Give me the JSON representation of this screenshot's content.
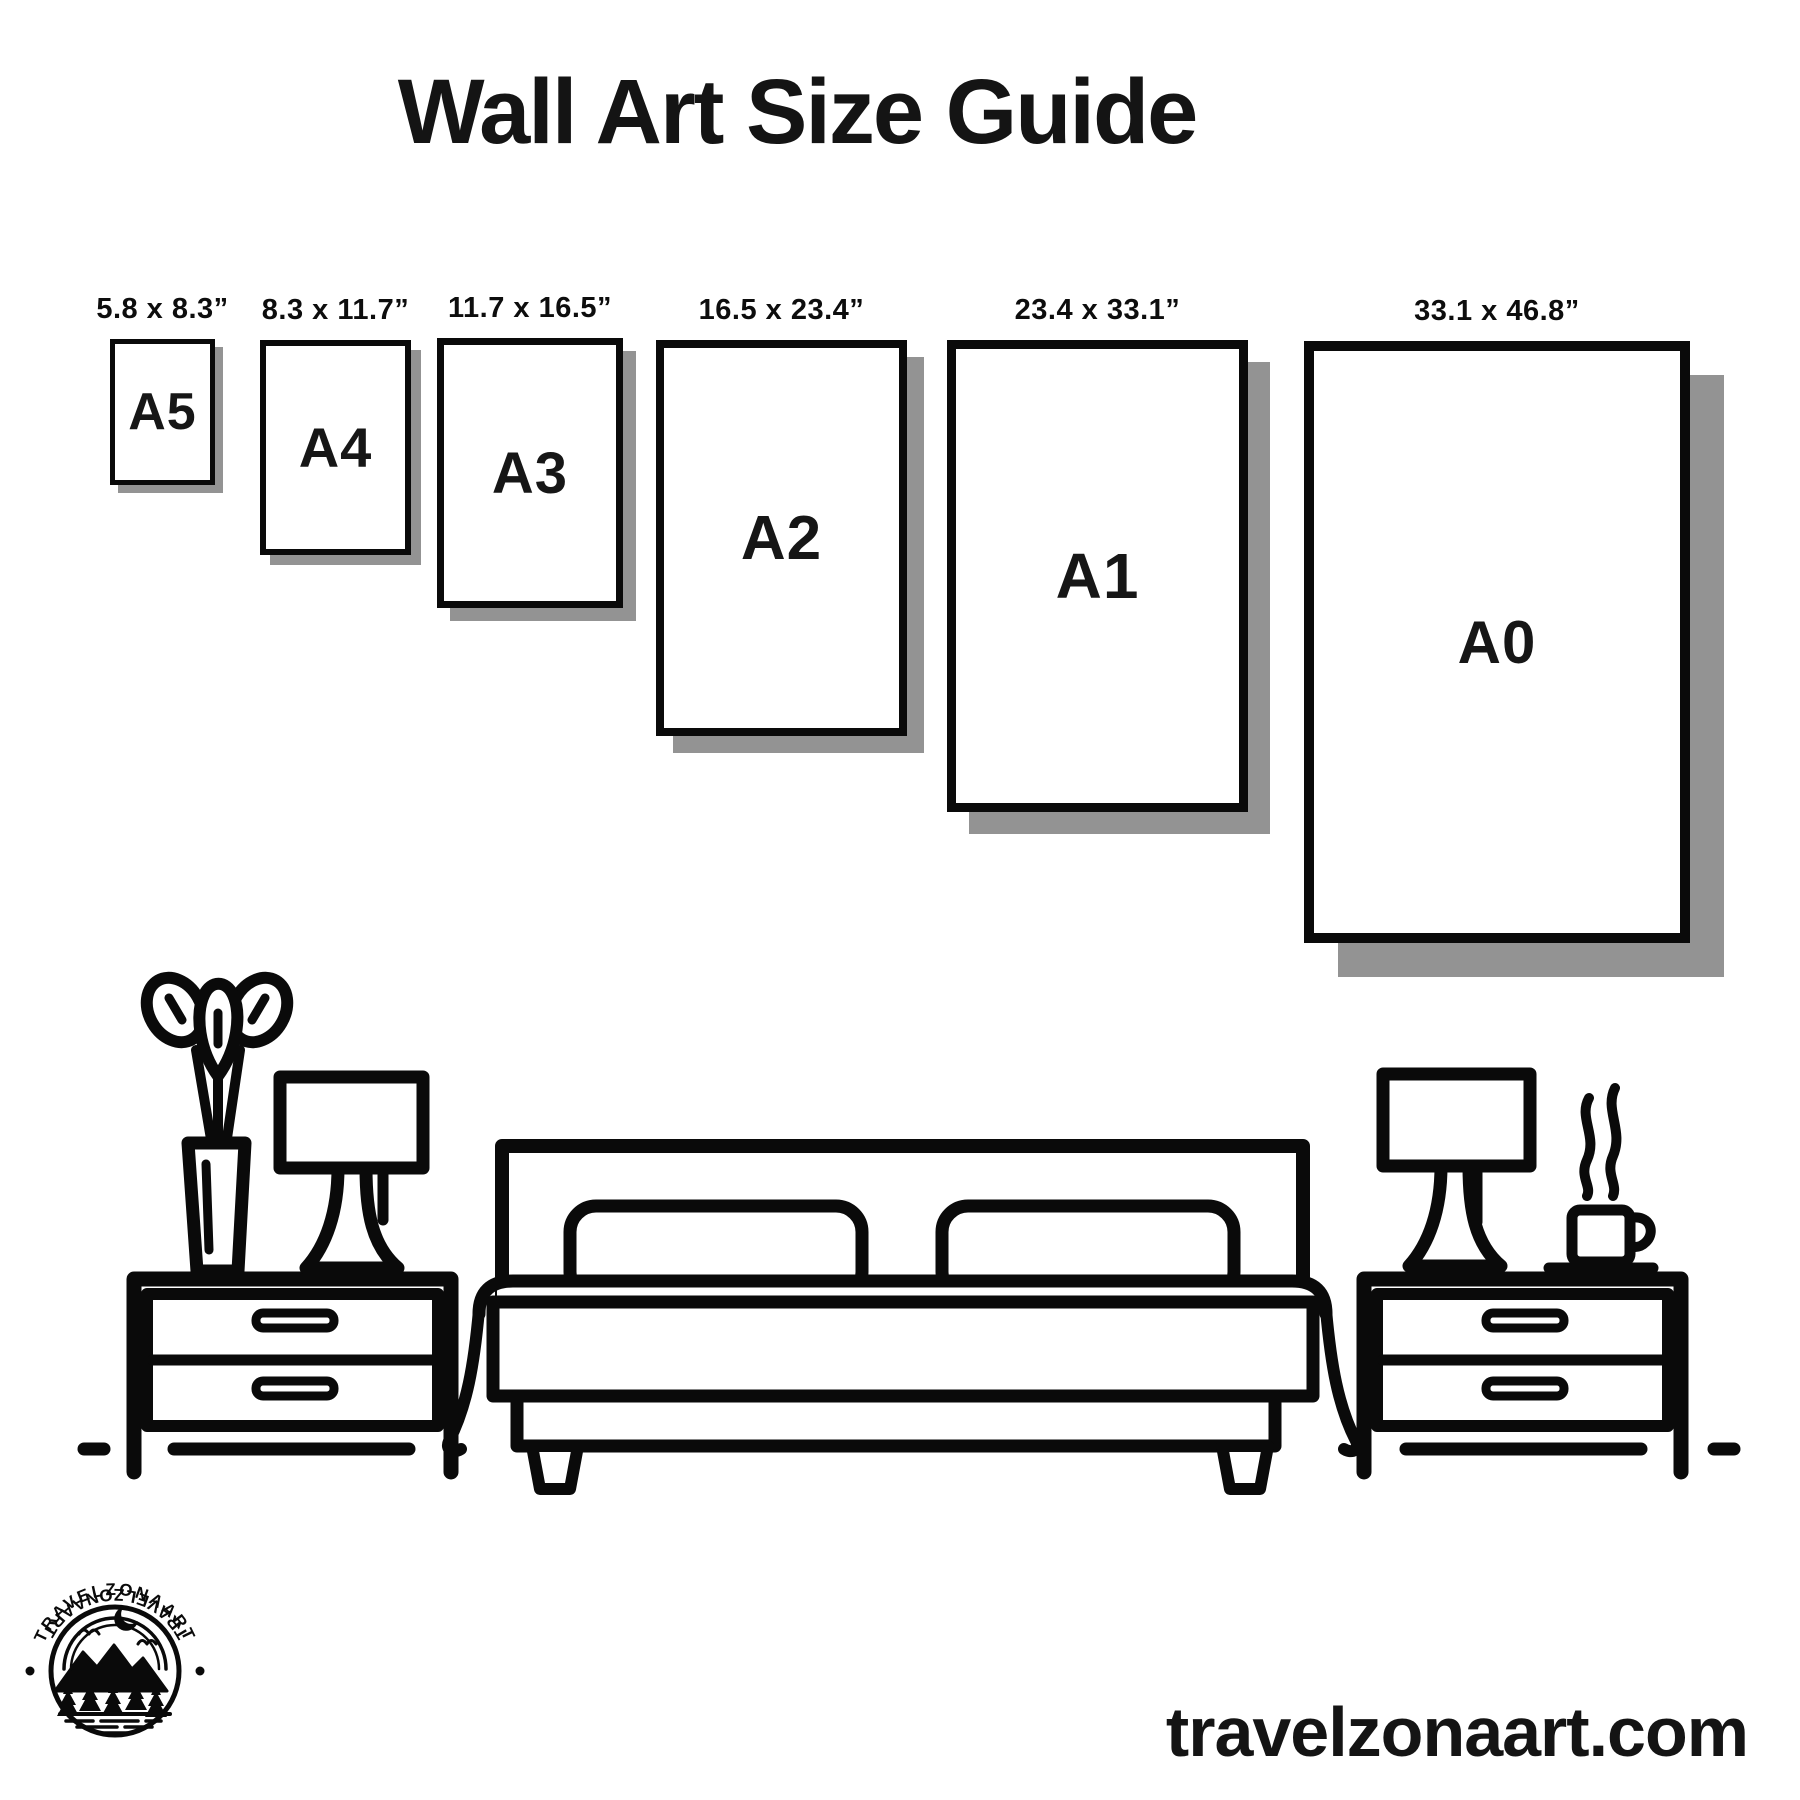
{
  "title": "Wall Art Size Guide",
  "size_guide": {
    "frames": [
      {
        "label": "A5",
        "dimensions": "5.8 x 8.3”"
      },
      {
        "label": "A4",
        "dimensions": "8.3 x 11.7”"
      },
      {
        "label": "A3",
        "dimensions": "11.7 x 16.5”"
      },
      {
        "label": "A2",
        "dimensions": "16.5 x 23.4”"
      },
      {
        "label": "A1",
        "dimensions": "23.4 x 33.1”"
      },
      {
        "label": "A0",
        "dimensions": "33.1 x 46.8”"
      }
    ]
  },
  "scene": {
    "icons": [
      "vase-plant-icon",
      "table-lamp-icon",
      "nightstand-icon",
      "bed-icon",
      "table-lamp-icon",
      "coffee-cup-icon",
      "nightstand-icon"
    ]
  },
  "brand": {
    "badge_text_top": "TRAVELZONAART",
    "badge_text_bottom": "TRAVELZONAART",
    "website": "travelzonaart.com"
  },
  "colors": {
    "ink": "#0a0a0a",
    "shadow": "#939393",
    "background": "#ffffff"
  }
}
